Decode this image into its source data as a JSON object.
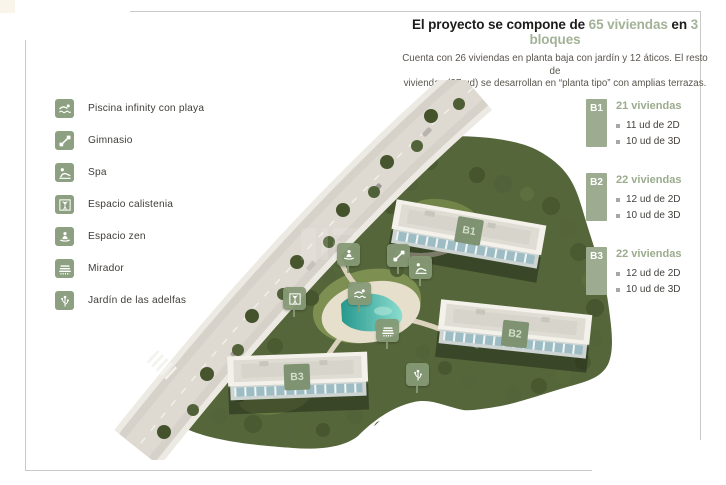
{
  "header": {
    "title_prefix": "El proyecto se compone de ",
    "title_highlight_units": "65 viviendas",
    "title_connector": " en ",
    "title_highlight_blocks": "3 bloques",
    "subtitle_line1": "Cuenta con 26 viviendas en planta baja con jardín y 12 áticos. El resto de",
    "subtitle_line2": "viviendas (27 ud) se desarrollan en “planta tipo” con amplias terrazas."
  },
  "legend": {
    "items": [
      {
        "icon": "pool-icon",
        "label": "Piscina infinity con playa"
      },
      {
        "icon": "gym-icon",
        "label": "Gimnasio"
      },
      {
        "icon": "spa-icon",
        "label": "Spa"
      },
      {
        "icon": "calisthenics-icon",
        "label": "Espacio calistenia"
      },
      {
        "icon": "zen-icon",
        "label": "Espacio zen"
      },
      {
        "icon": "viewpoint-icon",
        "label": "Mirador"
      },
      {
        "icon": "garden-icon",
        "label": "Jardín de las adelfas"
      }
    ]
  },
  "site_plan": {
    "building_labels": [
      {
        "id": "B1",
        "label": "B1"
      },
      {
        "id": "B2",
        "label": "B2"
      },
      {
        "id": "B3",
        "label": "B3"
      }
    ]
  },
  "blocks_panel": {
    "blocks": [
      {
        "code": "B1",
        "header": "21 viviendas",
        "items": [
          "11 ud de 2D",
          "10 ud de 3D"
        ]
      },
      {
        "code": "B2",
        "header": "22 viviendas",
        "items": [
          "12 ud de 2D",
          "10 ud de 3D"
        ]
      },
      {
        "code": "B3",
        "header": "22 viviendas",
        "items": [
          "12 ud de 2D",
          "10 ud de 3D"
        ]
      }
    ]
  },
  "colors": {
    "accent_green": "#9dac90",
    "accent_text": "#a3b297",
    "icon_green": "#8da081",
    "ink": "#1d1c1a",
    "muted_text": "#5a554e",
    "pool": "#3aa89b",
    "foliage": "#55663a"
  }
}
